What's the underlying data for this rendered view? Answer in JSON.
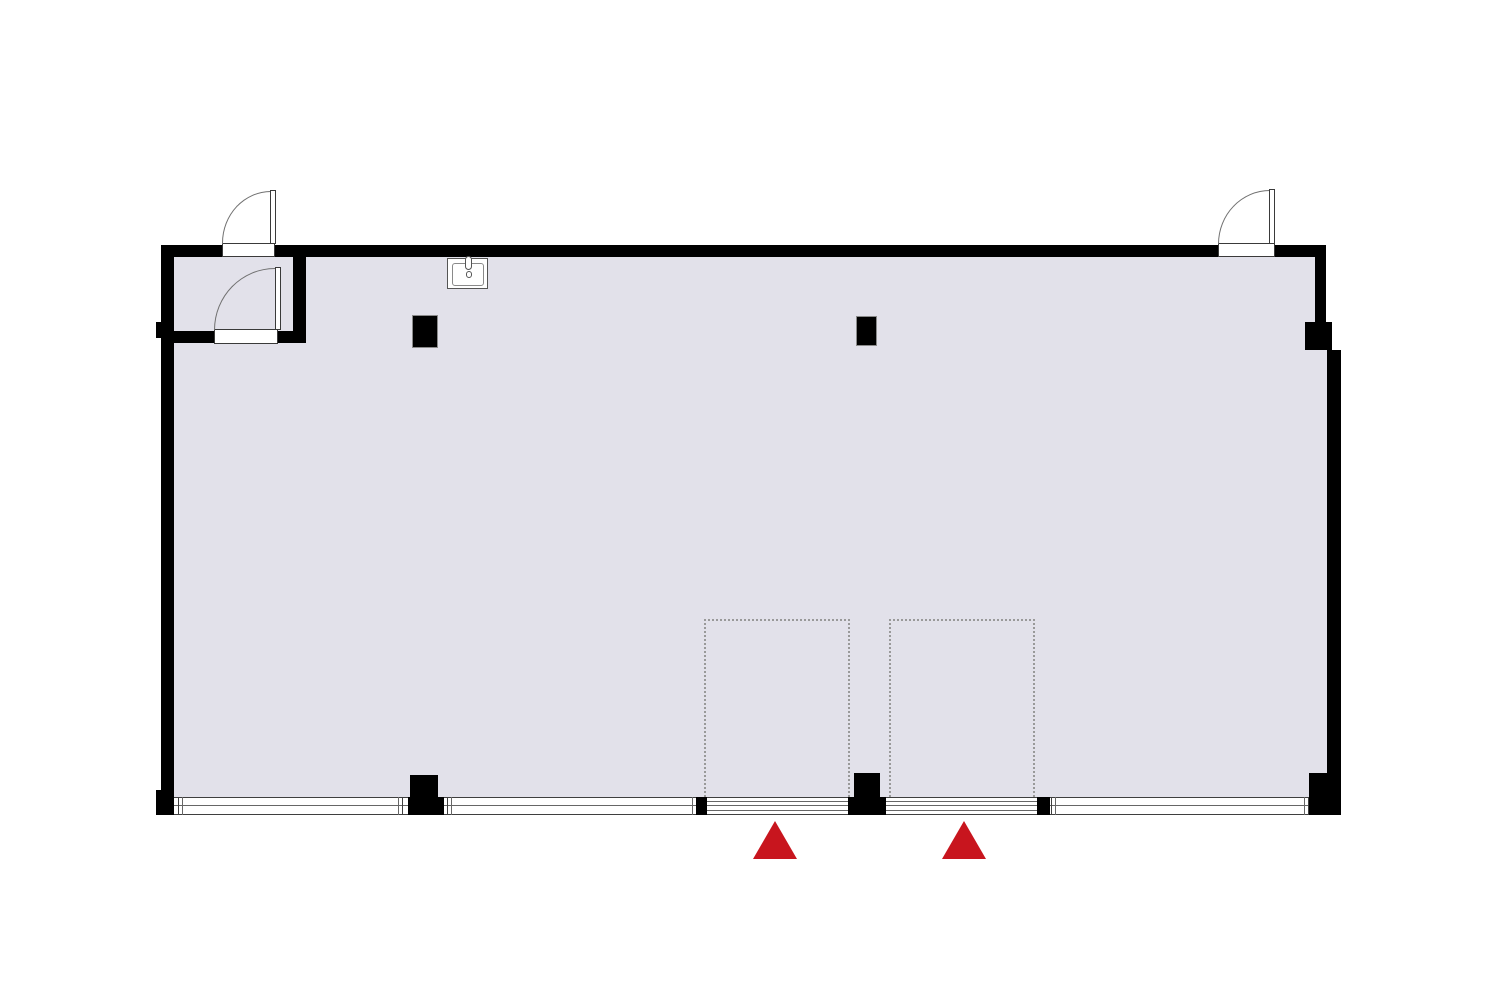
{
  "document": {
    "title": "Architectural floor plan",
    "type": "single-room floor plan with entry vestibule"
  },
  "colors": {
    "background": "#FFFFFF",
    "floor": "#E2E1EA",
    "wall": "#000000",
    "pillar-border": "#8A8A8A",
    "window-line": "#3F3F3F",
    "window-line-light": "#666666",
    "door-line": "#707070",
    "door-edge": "#3A3A3A",
    "dashed-area": "#999999",
    "entrance-marker": "#C8151E",
    "fixture-line": "#555555"
  },
  "elements": {
    "rooms": [
      {
        "name": "main-room",
        "fill": "#E2E1EA"
      },
      {
        "name": "entry-vestibule",
        "fill": "#E2E1EA",
        "location": "top-left"
      }
    ],
    "doors": [
      {
        "name": "exterior-door-top-left",
        "type": "hinged",
        "swing": "opens outward (up), hinge right"
      },
      {
        "name": "vestibule-interior-door",
        "type": "hinged",
        "swing": "opens into vestibule, hinge right"
      },
      {
        "name": "exterior-door-top-right",
        "type": "hinged",
        "swing": "opens outward (up), hinge right"
      }
    ],
    "windows": [
      {
        "name": "window-bottom-left"
      },
      {
        "name": "window-bottom-center"
      },
      {
        "name": "window-bottom-right"
      }
    ],
    "entrance_openings": [
      {
        "name": "entrance-opening-left",
        "style": "multi-track sliding"
      },
      {
        "name": "entrance-opening-right",
        "style": "multi-track sliding"
      }
    ],
    "entrance_markers": [
      {
        "name": "entrance-marker-left",
        "shape": "triangle-up",
        "color": "#C8151E"
      },
      {
        "name": "entrance-marker-right",
        "shape": "triangle-up",
        "color": "#C8151E"
      }
    ],
    "pillars": [
      {
        "name": "pillar-top-left"
      },
      {
        "name": "pillar-top-center"
      },
      {
        "name": "pillar-bottom-left"
      },
      {
        "name": "pillar-bottom-center"
      },
      {
        "name": "pillar-right-wall-jog"
      }
    ],
    "fixtures": [
      {
        "name": "sink",
        "location": "top-left area near vestibule"
      }
    ],
    "planned_areas": [
      {
        "name": "dashed-area-left",
        "style": "dotted outline"
      },
      {
        "name": "dashed-area-right",
        "style": "dotted outline"
      }
    ]
  }
}
